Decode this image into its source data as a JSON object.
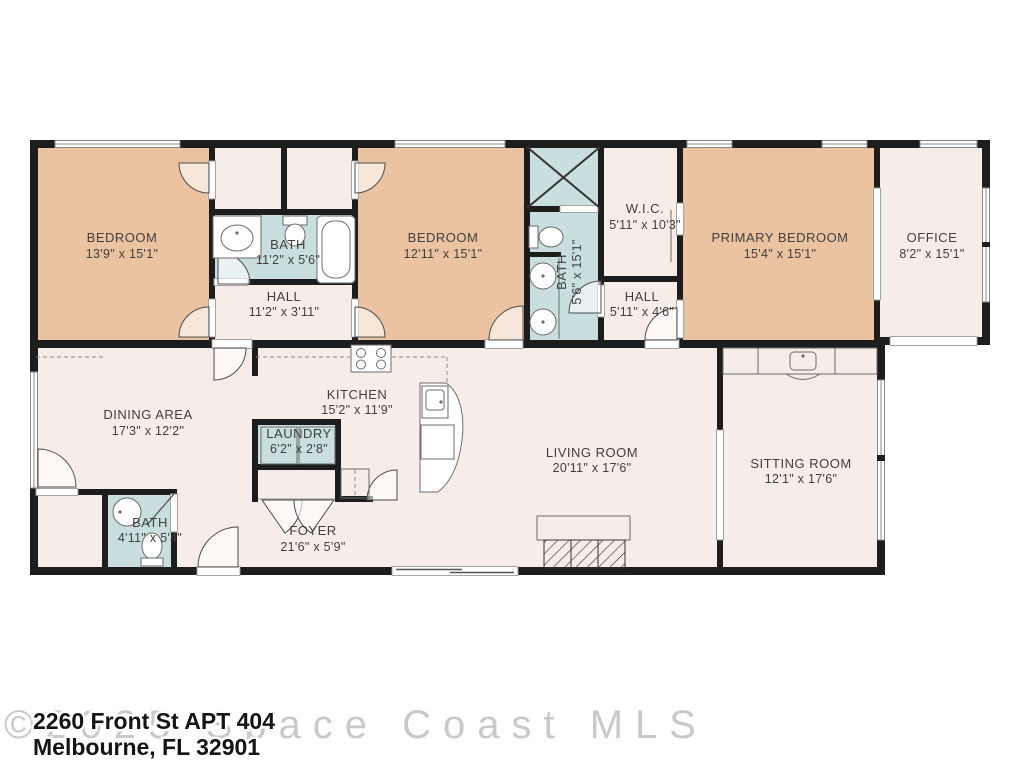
{
  "floor_plan": {
    "rooms": [
      {
        "id": "bedroom-1",
        "name": "BEDROOM",
        "dims": "13'9\" x 15'1\""
      },
      {
        "id": "bath-1",
        "name": "BATH",
        "dims": "11'2\" x 5'6\""
      },
      {
        "id": "hall-1",
        "name": "HALL",
        "dims": "11'2\" x 3'11\""
      },
      {
        "id": "bedroom-2",
        "name": "BEDROOM",
        "dims": "12'11\" x 15'1\""
      },
      {
        "id": "bath-2",
        "name": "BATH",
        "dims": "5'6\" x 15'1\""
      },
      {
        "id": "wic",
        "name": "W.I.C.",
        "dims": "5'11\" x 10'3\""
      },
      {
        "id": "hall-2",
        "name": "HALL",
        "dims": "5'11\" x 4'6\""
      },
      {
        "id": "primary-bedroom",
        "name": "PRIMARY BEDROOM",
        "dims": "15'4\" x 15'1\""
      },
      {
        "id": "office",
        "name": "OFFICE",
        "dims": "8'2\" x 15'1\""
      },
      {
        "id": "dining-area",
        "name": "DINING AREA",
        "dims": "17'3\" x 12'2\""
      },
      {
        "id": "kitchen",
        "name": "KITCHEN",
        "dims": "15'2\" x 11'9\""
      },
      {
        "id": "laundry",
        "name": "LAUNDRY",
        "dims": "6'2\" x 2'8\""
      },
      {
        "id": "bath-3",
        "name": "BATH",
        "dims": "4'11\" x 5'4\""
      },
      {
        "id": "foyer",
        "name": "FOYER",
        "dims": "21'6\" x 5'9\""
      },
      {
        "id": "living-room",
        "name": "LIVING ROOM",
        "dims": "20'11\" x 17'6\""
      },
      {
        "id": "sitting-room",
        "name": "SITTING ROOM",
        "dims": "12'1\" x 17'6\""
      }
    ],
    "colors": {
      "bedroom_fill": "#EBC3A0",
      "bath_fill": "#C9DFDF",
      "room_fill": "#F6EDE8",
      "wall": "#1D1D1D",
      "background": "#FFFFFF",
      "label_text": "#3F3F3F",
      "watermark_gray": "#C9C9C9"
    }
  },
  "address": {
    "line1": "2260 Front St APT 404",
    "line2": "Melbourne, FL 32901"
  },
  "watermark": "©2025 Space Coast MLS"
}
